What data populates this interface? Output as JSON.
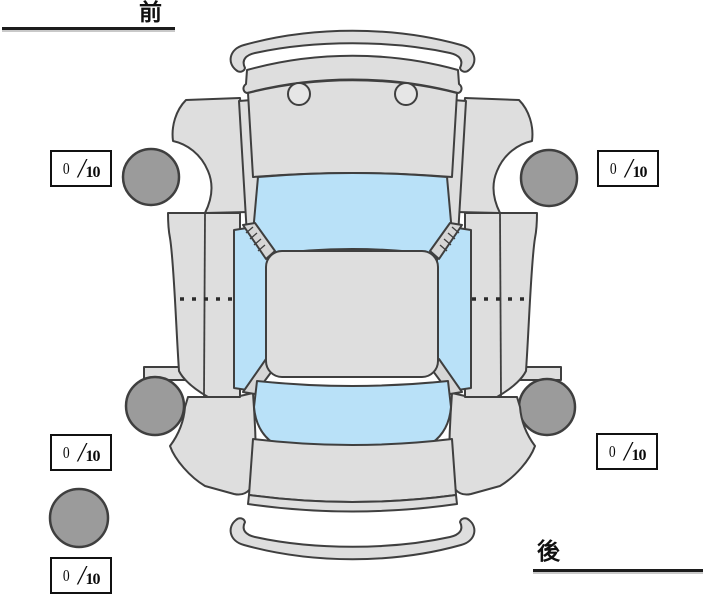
{
  "diagram": {
    "type": "vehicle-top-view-tire-condition",
    "orientation": {
      "front_label": "前",
      "rear_label": "後"
    },
    "tire_scores": {
      "front_left": {
        "value": "0",
        "slash": "/",
        "max": "10"
      },
      "front_right": {
        "value": "0",
        "slash": "/",
        "max": "10"
      },
      "rear_left": {
        "value": "0",
        "slash": "/",
        "max": "10"
      },
      "rear_right": {
        "value": "0",
        "slash": "/",
        "max": "10"
      },
      "spare": {
        "value": "0",
        "slash": "/",
        "max": "10"
      }
    },
    "colors": {
      "background": "#ffffff",
      "car_body": "#dedede",
      "pillar_gray": "#d6d6d6",
      "headlight_gray": "#e6e6e6",
      "window_glass": "#b9e1f8",
      "tire_fill": "#9b9b9b",
      "outline": "#3f3f3f",
      "score_box_border": "#111111",
      "label_text": "#111111"
    }
  }
}
